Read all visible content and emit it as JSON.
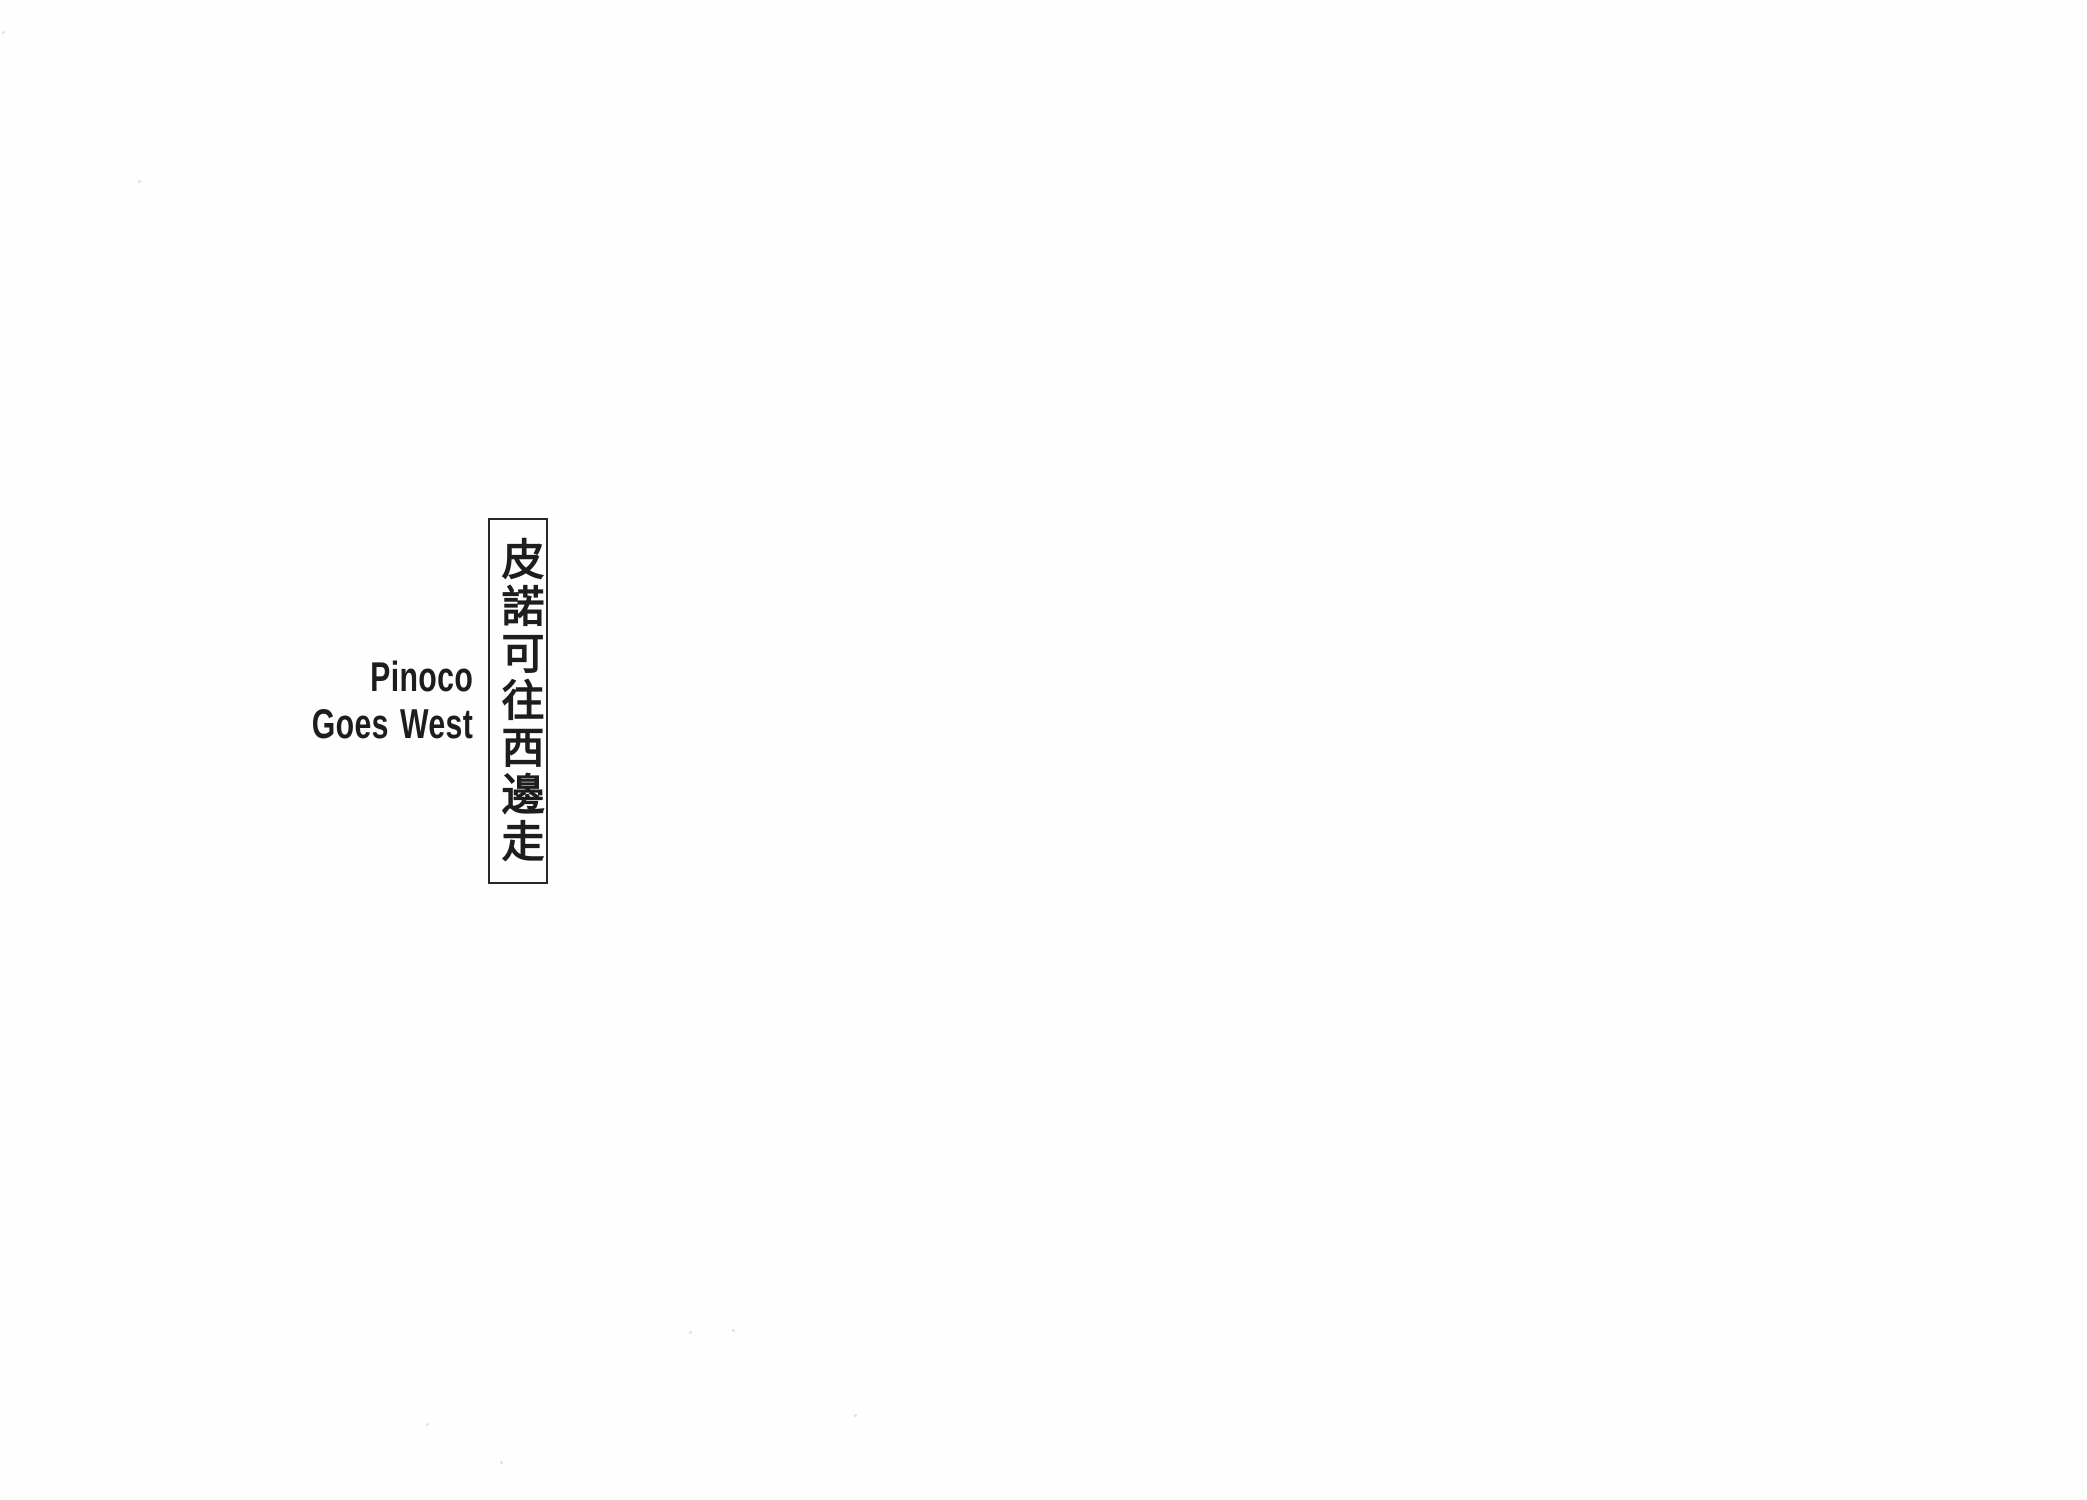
{
  "page": {
    "background_color": "#fefefe",
    "ink_color": "#1d1d1d"
  },
  "title_box": {
    "text": "皮諾可往西邊走",
    "border_color": "#272727"
  },
  "english_title": {
    "line1": "Pinoco",
    "line2": "Goes West"
  },
  "dust_specks": [
    {
      "x": 2,
      "y": 31
    },
    {
      "x": 138,
      "y": 180
    },
    {
      "x": 689,
      "y": 1331
    },
    {
      "x": 732,
      "y": 1329
    },
    {
      "x": 426,
      "y": 1423
    },
    {
      "x": 500,
      "y": 1461
    },
    {
      "x": 854,
      "y": 1414
    }
  ],
  "speck_color": "#cccccc"
}
